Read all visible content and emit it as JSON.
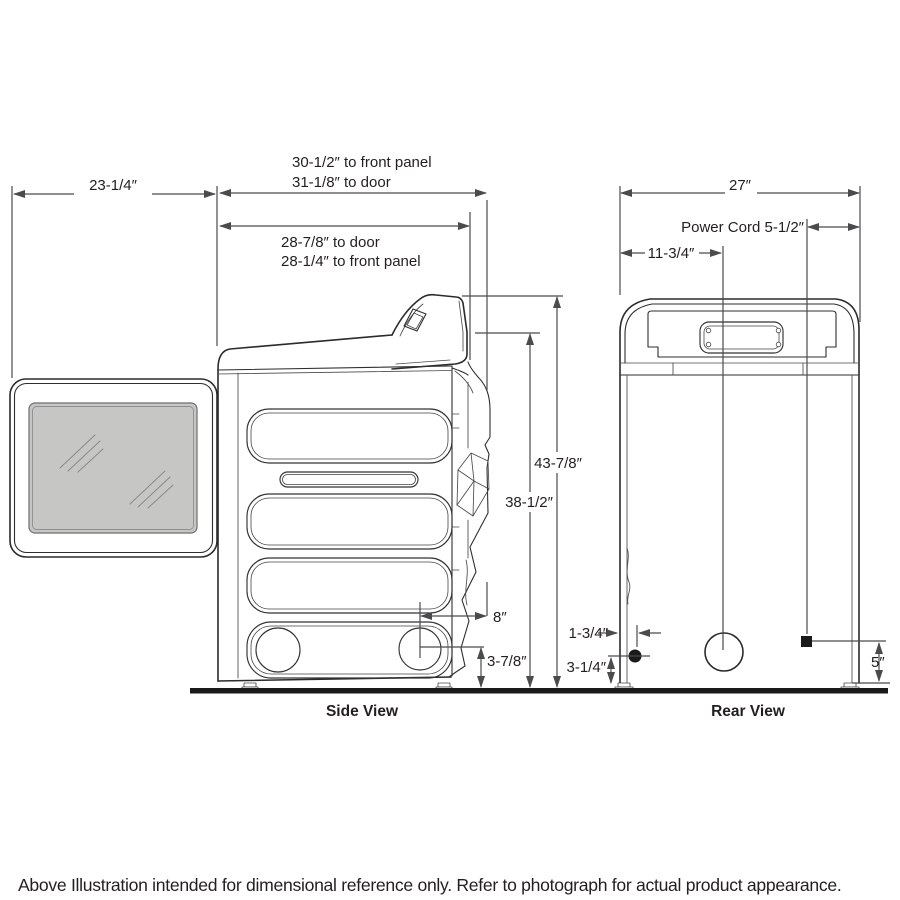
{
  "side_view": {
    "label": "Side View",
    "dims": {
      "depth_front_panel": "30-1/2″ to front panel",
      "depth_door": "31-1/8″ to door",
      "door_open_depth": "23-1/4″",
      "upper_to_door": "28-7/8″ to door",
      "upper_to_front_panel": "28-1/4″ to front panel",
      "height_total": "43-7/8″",
      "height_body": "38-1/2″",
      "exhaust_offset": "8″",
      "exhaust_height": "3-7/8″"
    }
  },
  "rear_view": {
    "label": "Rear View",
    "dims": {
      "width": "27″",
      "power_cord": "Power Cord 5-1/2″",
      "vent_from_side": "11-3/4″",
      "inlet_from_side": "1-3/4″",
      "inlet_height": "3-1/4″",
      "cord_height": "5″"
    }
  },
  "caption": "Above Illustration intended for dimensional reference only. Refer to photograph for actual product appearance.",
  "colors": {
    "line": "#2b2b2b",
    "dim_line": "#4a4b4d",
    "glass_fill": "#c6c7c5",
    "ink": "#1a1a1a",
    "background": "#ffffff"
  }
}
